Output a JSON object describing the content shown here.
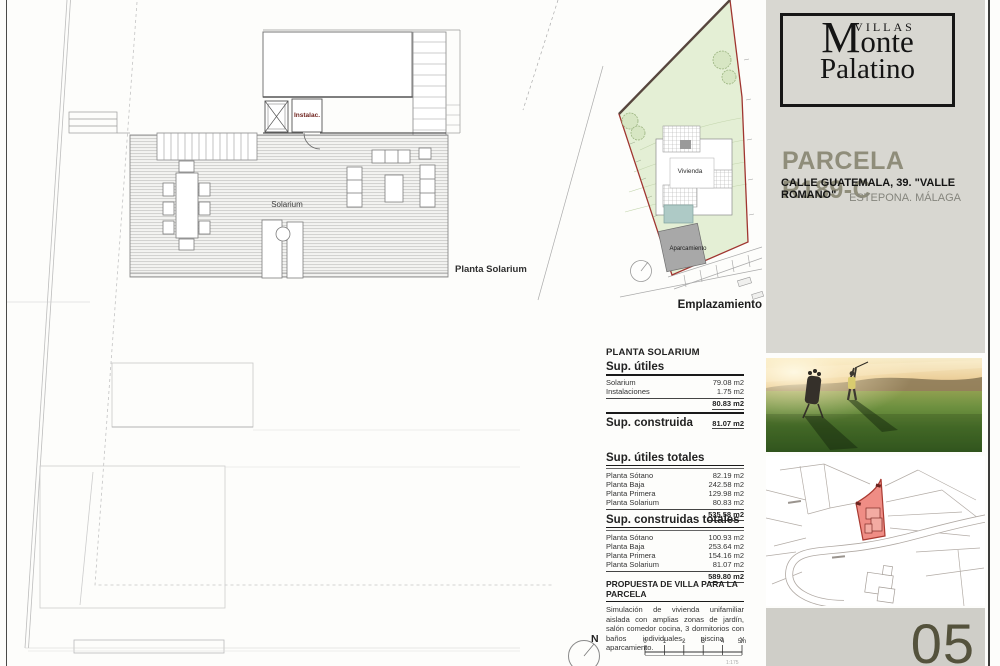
{
  "plan": {
    "title": "Planta Solarium",
    "room_solarium": "Solarium",
    "room_instalac": "Instalac."
  },
  "site_plan": {
    "vivienda_label": "Vivienda",
    "aparcamiento_label": "Aparcamiento",
    "caption": "Emplazamiento"
  },
  "tables": {
    "section_header": "PLANTA SOLARIUM",
    "utiles": {
      "title": "Sup. útiles",
      "rows": [
        {
          "label": "Solarium",
          "value": "79.08 m2"
        },
        {
          "label": "Instalaciones",
          "value": "1.75 m2"
        }
      ],
      "total": "80.83 m2"
    },
    "construida": {
      "title": "Sup. construida",
      "value": "81.07 m2"
    },
    "utiles_totales": {
      "title": "Sup. útiles totales",
      "rows": [
        {
          "label": "Planta Sótano",
          "value": "82.19 m2"
        },
        {
          "label": "Planta Baja",
          "value": "242.58 m2"
        },
        {
          "label": "Planta Primera",
          "value": "129.98 m2"
        },
        {
          "label": "Planta Solarium",
          "value": "80.83 m2"
        }
      ],
      "total": "535.58 m2"
    },
    "construidas_totales": {
      "title": "Sup. construidas totales",
      "rows": [
        {
          "label": "Planta Sótano",
          "value": "100.93 m2"
        },
        {
          "label": "Planta Baja",
          "value": "253.64 m2"
        },
        {
          "label": "Planta Primera",
          "value": "154.16 m2"
        },
        {
          "label": "Planta Solarium",
          "value": "81.07 m2"
        }
      ],
      "total": "589.80 m2"
    }
  },
  "propuesta": {
    "title": "PROPUESTA DE VILLA PARA LA PARCELA",
    "body": "Simulación de vivienda unifamiliar aislada con amplias zonas de jardín, salón comedor cocina, 3 dormitorios con baños individuales, piscina y aparcamiento."
  },
  "scale_bar": {
    "ticks": [
      "0",
      "1",
      "2",
      "3",
      "4",
      "5m"
    ],
    "note": "1:175"
  },
  "compass": {
    "label": "N"
  },
  "sidebar": {
    "logo": {
      "villas": "VILLAS",
      "monte_initial": "M",
      "monte_rest": "onte",
      "palatino": "Palatino"
    },
    "parcel_title": "PARCELA R189-C",
    "address_line1": "CALLE GUATEMALA, 39. \"VALLE ROMANO\"",
    "address_line2": "ESTEPONA. MÁLAGA",
    "page_number": "05"
  },
  "colors": {
    "panel_gray": "#d8d7d1",
    "panel_gray_dark": "#cfcec8",
    "parcel_title": "#8f8d7a",
    "site_green": "#e4efd5",
    "boundary_red": "#a03530",
    "map_parcel_fill": "#ef8d85",
    "pool_blue": "#aecac6",
    "parking_gray": "#a8a8a8",
    "instalac_red": "#70241f"
  }
}
